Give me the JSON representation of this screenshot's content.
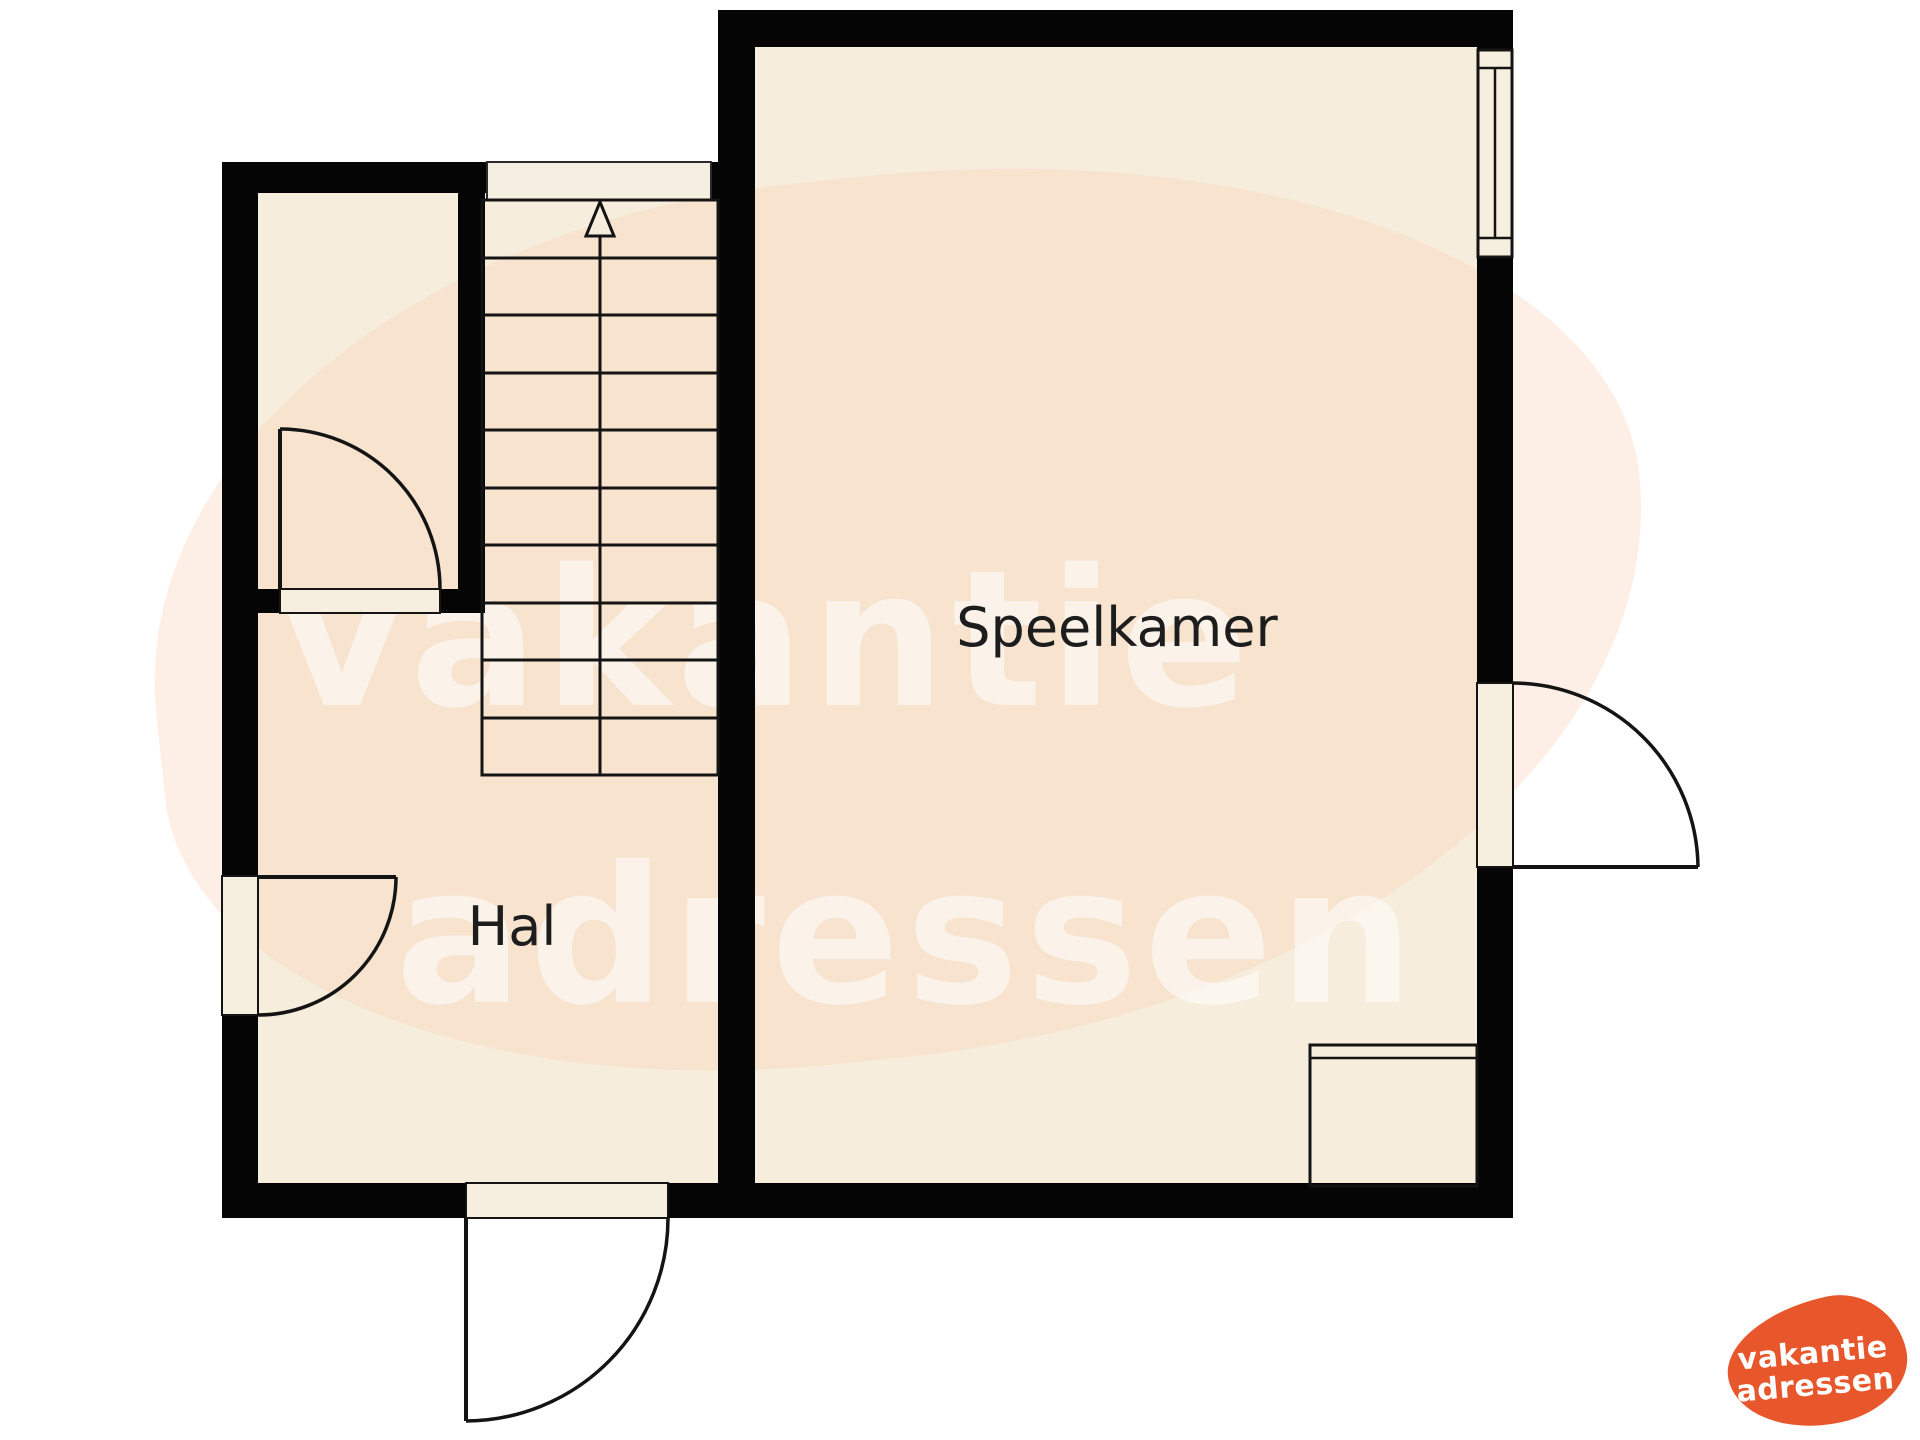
{
  "labels": {
    "speelkamer": "Speelkamer",
    "hal": "Hal"
  },
  "watermark": {
    "line1": "vakantie",
    "line2": "adressen"
  },
  "logo": {
    "line1": "vakantie",
    "line2": "adressen",
    "brand_color": "#e8572b",
    "text_color": "#ffffff"
  },
  "colors": {
    "wall": "#050505",
    "floor": "#f6eddc",
    "blob_tint": "#fceae1",
    "linework": "#141414",
    "label_text": "#1d1d1d"
  },
  "stairs": {
    "step_count": 10,
    "direction_icon": "up-arrow"
  }
}
